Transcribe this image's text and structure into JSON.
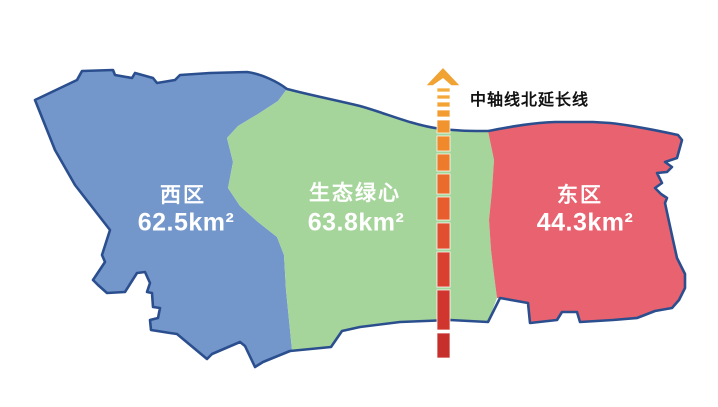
{
  "map": {
    "outline_color": "#2B4F8E",
    "label_text_color": "#FFFFFF",
    "regions": [
      {
        "id": "west",
        "name": "西区",
        "area": "62.5km²",
        "color": "#7397CB"
      },
      {
        "id": "green-heart",
        "name": "生态绿心",
        "area": "63.8km²",
        "color": "#A6D59C"
      },
      {
        "id": "east",
        "name": "东区",
        "area": "44.3km²",
        "color": "#E8636F"
      }
    ]
  },
  "axis": {
    "label": "中轴线北延长线",
    "arrow_color": "#F0A232",
    "x": 437,
    "width": 13,
    "segments": [
      {
        "y": 88,
        "h": 4,
        "color": "#F4AC3A"
      },
      {
        "y": 95,
        "h": 4,
        "color": "#F4A837"
      },
      {
        "y": 102,
        "h": 5,
        "color": "#F3A334"
      },
      {
        "y": 110,
        "h": 7,
        "color": "#F29C31"
      },
      {
        "y": 120,
        "h": 13,
        "color": "#F1932E"
      },
      {
        "y": 136,
        "h": 15,
        "color": "#F0882C"
      },
      {
        "y": 154,
        "h": 17,
        "color": "#EE7A2B"
      },
      {
        "y": 174,
        "h": 20,
        "color": "#EB6B2D"
      },
      {
        "y": 197,
        "h": 23,
        "color": "#E75D2E"
      },
      {
        "y": 223,
        "h": 26,
        "color": "#E24E30"
      },
      {
        "y": 252,
        "h": 35,
        "color": "#DA4030"
      },
      {
        "y": 290,
        "h": 40,
        "color": "#D0352E"
      },
      {
        "y": 333,
        "h": 25,
        "color": "#C62F2B"
      }
    ]
  }
}
